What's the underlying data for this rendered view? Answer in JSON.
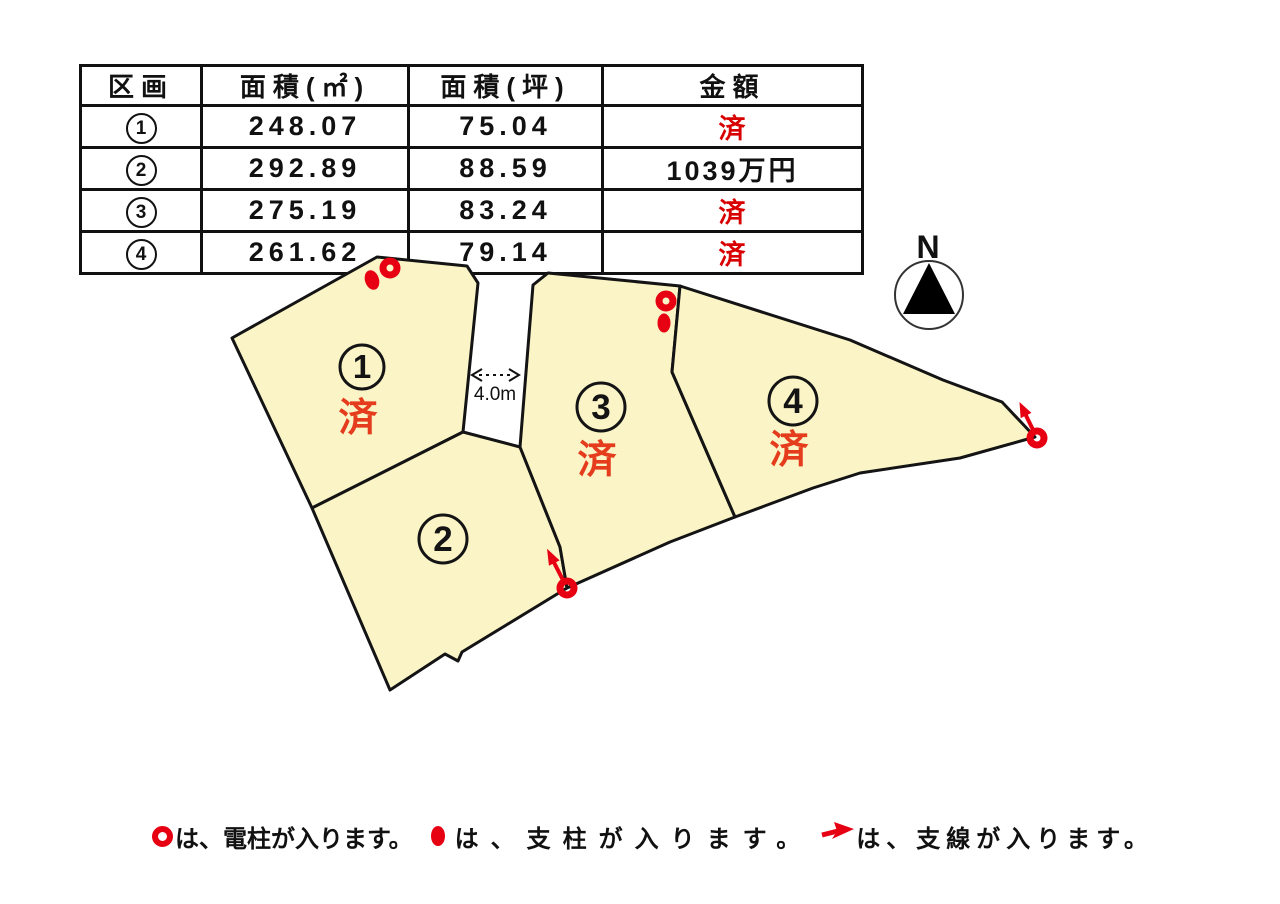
{
  "table": {
    "headers": [
      "区画",
      "面積(㎡)",
      "面積(坪)",
      "金額"
    ],
    "rows": [
      {
        "no": "1",
        "m2": "248.07",
        "tsubo": "75.04",
        "price": "済"
      },
      {
        "no": "2",
        "m2": "292.89",
        "tsubo": "88.59",
        "price": "1039万円"
      },
      {
        "no": "3",
        "m2": "275.19",
        "tsubo": "83.24",
        "price": "済"
      },
      {
        "no": "4",
        "m2": "261.62",
        "tsubo": "79.14",
        "price": "済"
      }
    ]
  },
  "map": {
    "plots": [
      {
        "no": "1",
        "status": "済"
      },
      {
        "no": "2",
        "status": ""
      },
      {
        "no": "3",
        "status": "済"
      },
      {
        "no": "4",
        "status": "済"
      }
    ],
    "road_width_label": "4.0m",
    "compass_label": "N"
  },
  "legend": {
    "items": [
      {
        "symbol": "utility-pole-ring",
        "text": "は、電柱が入ります。"
      },
      {
        "symbol": "support-post-dot",
        "text": "は、支柱が入ります。"
      },
      {
        "symbol": "guy-wire-arrow",
        "text": "は、支線が入ります。"
      }
    ]
  },
  "colors": {
    "plot_fill": "#faf4c6",
    "outline": "#141414",
    "marker_red": "#e60012",
    "map_status_red": "#e43c1c",
    "table_price_red": "#d80000"
  }
}
